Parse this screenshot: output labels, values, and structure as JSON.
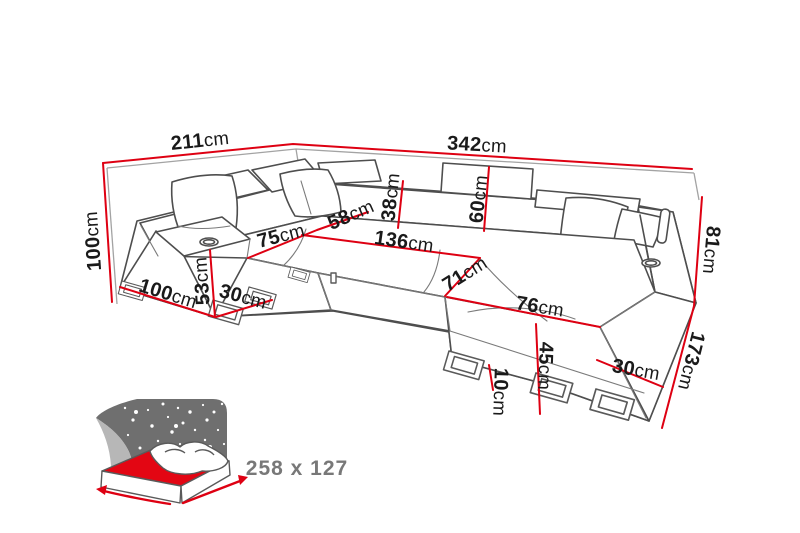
{
  "diagram_type": "corner-sofa-dimension-drawing",
  "colors": {
    "dimension_red": "#de0012",
    "sketch_dark_gray": "#4e4e4e",
    "seam_gray": "#7a7a7a",
    "box_gray": "#a3a3a3",
    "label_black": "#1a1a1a",
    "bed_panel_gray": "#6f6f6f",
    "crescent_gray": "#b7b7b7",
    "mattress_red": "#e30613",
    "caption_gray": "#787878"
  },
  "dims": [
    {
      "id": "back-width-left",
      "v": "211",
      "u": "cm"
    },
    {
      "id": "back-width-right",
      "v": "342",
      "u": "cm"
    },
    {
      "id": "total-height",
      "v": "100",
      "u": "cm"
    },
    {
      "id": "seat-depth-left",
      "v": "75",
      "u": "cm"
    },
    {
      "id": "seat-depth-corner",
      "v": "58",
      "u": "cm"
    },
    {
      "id": "backrest-depth",
      "v": "38",
      "u": "cm"
    },
    {
      "id": "backrest-height",
      "v": "60",
      "u": "cm"
    },
    {
      "id": "inner-width-middle",
      "v": "136",
      "u": "cm"
    },
    {
      "id": "chaise-inner-depth",
      "v": "71",
      "u": "cm"
    },
    {
      "id": "chaise-width",
      "v": "76",
      "u": "cm"
    },
    {
      "id": "side-height-right",
      "v": "81",
      "u": "cm"
    },
    {
      "id": "armrest-depth-left",
      "v": "100",
      "u": "cm"
    },
    {
      "id": "armrest-height-left",
      "v": "53",
      "u": "cm"
    },
    {
      "id": "base-width-left",
      "v": "30",
      "u": "cm"
    },
    {
      "id": "chaise-front-height",
      "v": "45",
      "u": "cm"
    },
    {
      "id": "leg-height",
      "v": "10",
      "u": "cm"
    },
    {
      "id": "base-width-right",
      "v": "30",
      "u": "cm"
    },
    {
      "id": "side-length-right",
      "v": "173",
      "u": "cm"
    }
  ],
  "sleeping_function": {
    "icon": "sofa-bed-sleeping-function-icon",
    "label": "258 x 127"
  }
}
